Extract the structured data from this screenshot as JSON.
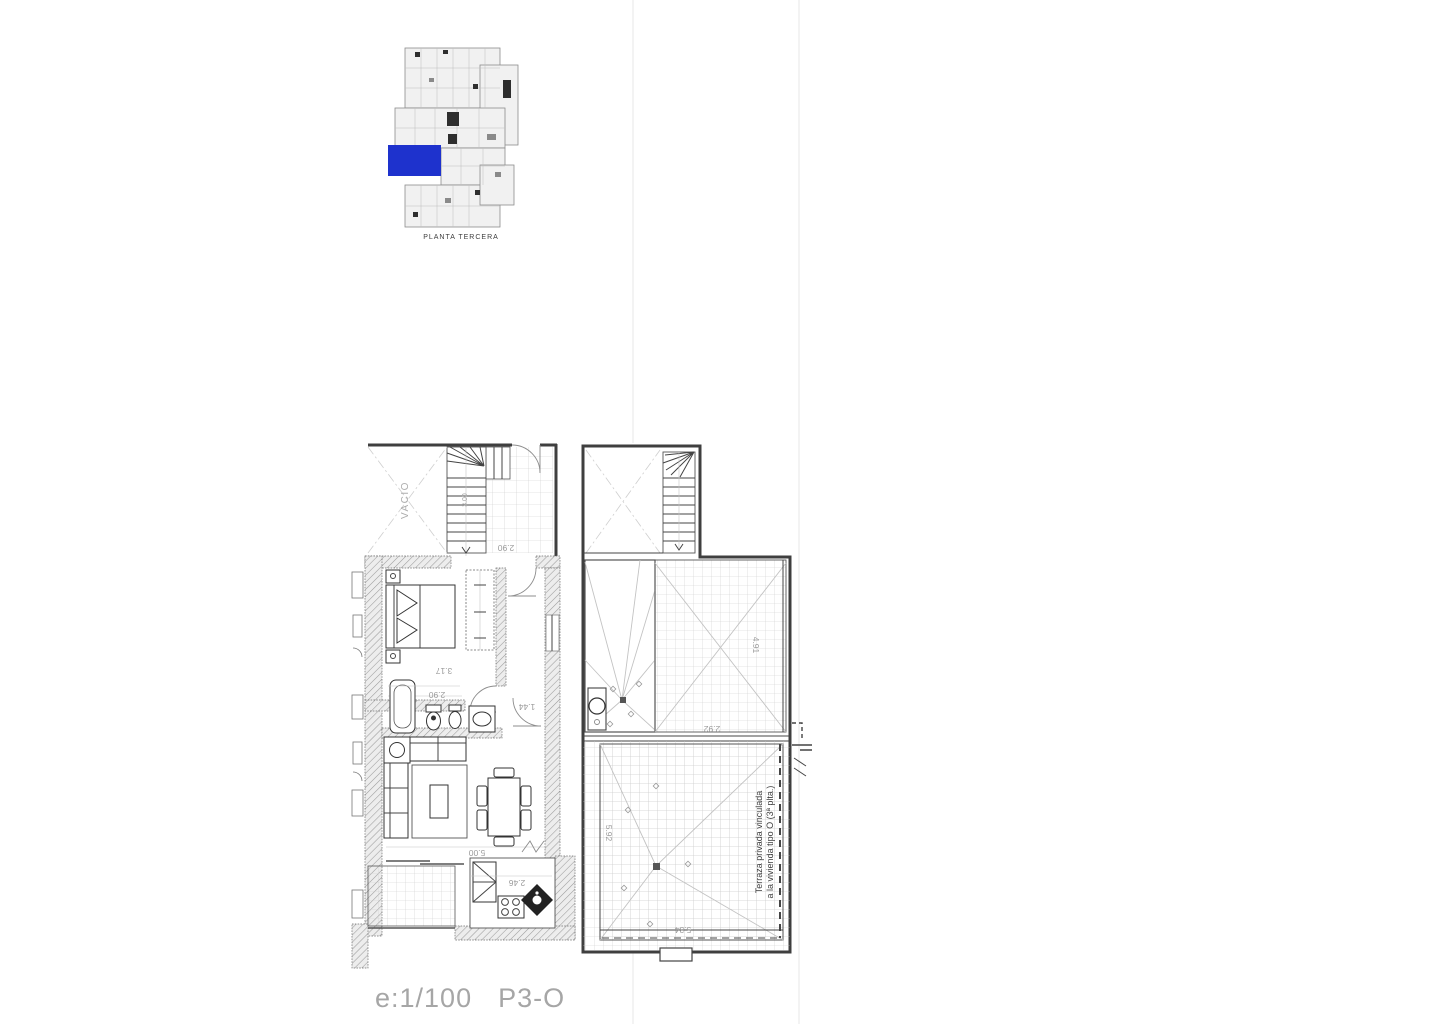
{
  "key_plan": {
    "title": "PLANTA TERCERA",
    "highlight_color": "#1e32cd"
  },
  "floor_plan": {
    "labels": {
      "void": "VACIO",
      "terrace_note_line1": "Terraza privada vinculada",
      "terrace_note_line2": "a la vivienda tipo O (3ª plta.)"
    },
    "dimensions": {
      "d_landing": "2.90",
      "d_stair": "3.00",
      "d_bedroom": "3.17",
      "d_bath": "2.90",
      "d_hall": "1.44",
      "d_living": "5.00",
      "d_kitchen": "2.46",
      "d_roof_terrace_h": "4.91",
      "d_roof_terrace_w": "2.92",
      "d_terrace_h": "5.92",
      "d_terrace_w": "5.34"
    }
  },
  "footer": {
    "scale_label": "e:1/100",
    "plan_code": "P3-O"
  }
}
